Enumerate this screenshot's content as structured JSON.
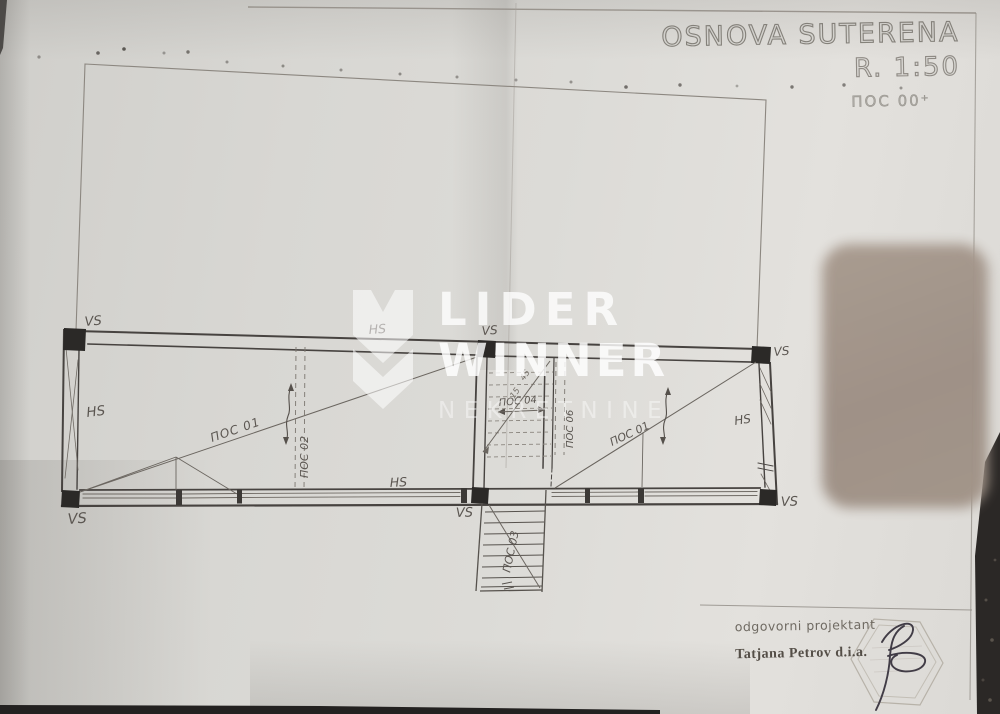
{
  "title_block": {
    "title": "OSNOVA SUTERENA",
    "scale": "R. 1:50",
    "position_label": "ПОС 00⁺"
  },
  "watermark": {
    "line1": "LIDER",
    "line2": "WINNER",
    "line3": "NEKRETNINE"
  },
  "signature_block": {
    "role_label": "odgovorni projektant",
    "name": "Tatjana Petrov d.i.a."
  },
  "plan": {
    "labels": [
      {
        "id": "vs-top-left",
        "text": "VS"
      },
      {
        "id": "hs-top-center-left",
        "text": "HS"
      },
      {
        "id": "vs-top-center",
        "text": "VS"
      },
      {
        "id": "vs-top-right",
        "text": "VS"
      },
      {
        "id": "hs-left-wall",
        "text": "HS"
      },
      {
        "id": "hs-right-wall",
        "text": "HS"
      },
      {
        "id": "hs-bottom-wall",
        "text": "HS"
      },
      {
        "id": "vs-bottom-left",
        "text": "VS"
      },
      {
        "id": "vs-bottom-center",
        "text": "VS"
      },
      {
        "id": "vs-bottom-right",
        "text": "VS"
      }
    ],
    "pos_labels": [
      {
        "id": "pos-01-left",
        "text": "ПОС 01"
      },
      {
        "id": "pos-02",
        "text": "ПОС 02"
      },
      {
        "id": "pos-03",
        "text": "ПОС 03"
      },
      {
        "id": "pos-04",
        "text": "ПОС 04"
      },
      {
        "id": "pos-06",
        "text": "ПОС 06"
      },
      {
        "id": "pos-01-right",
        "text": "ПОС 01"
      }
    ],
    "stair_notes": [
      {
        "text": "15"
      },
      {
        "text": "45"
      }
    ]
  },
  "colors": {
    "paper": "#dcdbd7",
    "photo_background": "#262422",
    "ink": "#474340",
    "watermark_white": "#ffffff",
    "object_brown": "#a3958a"
  }
}
